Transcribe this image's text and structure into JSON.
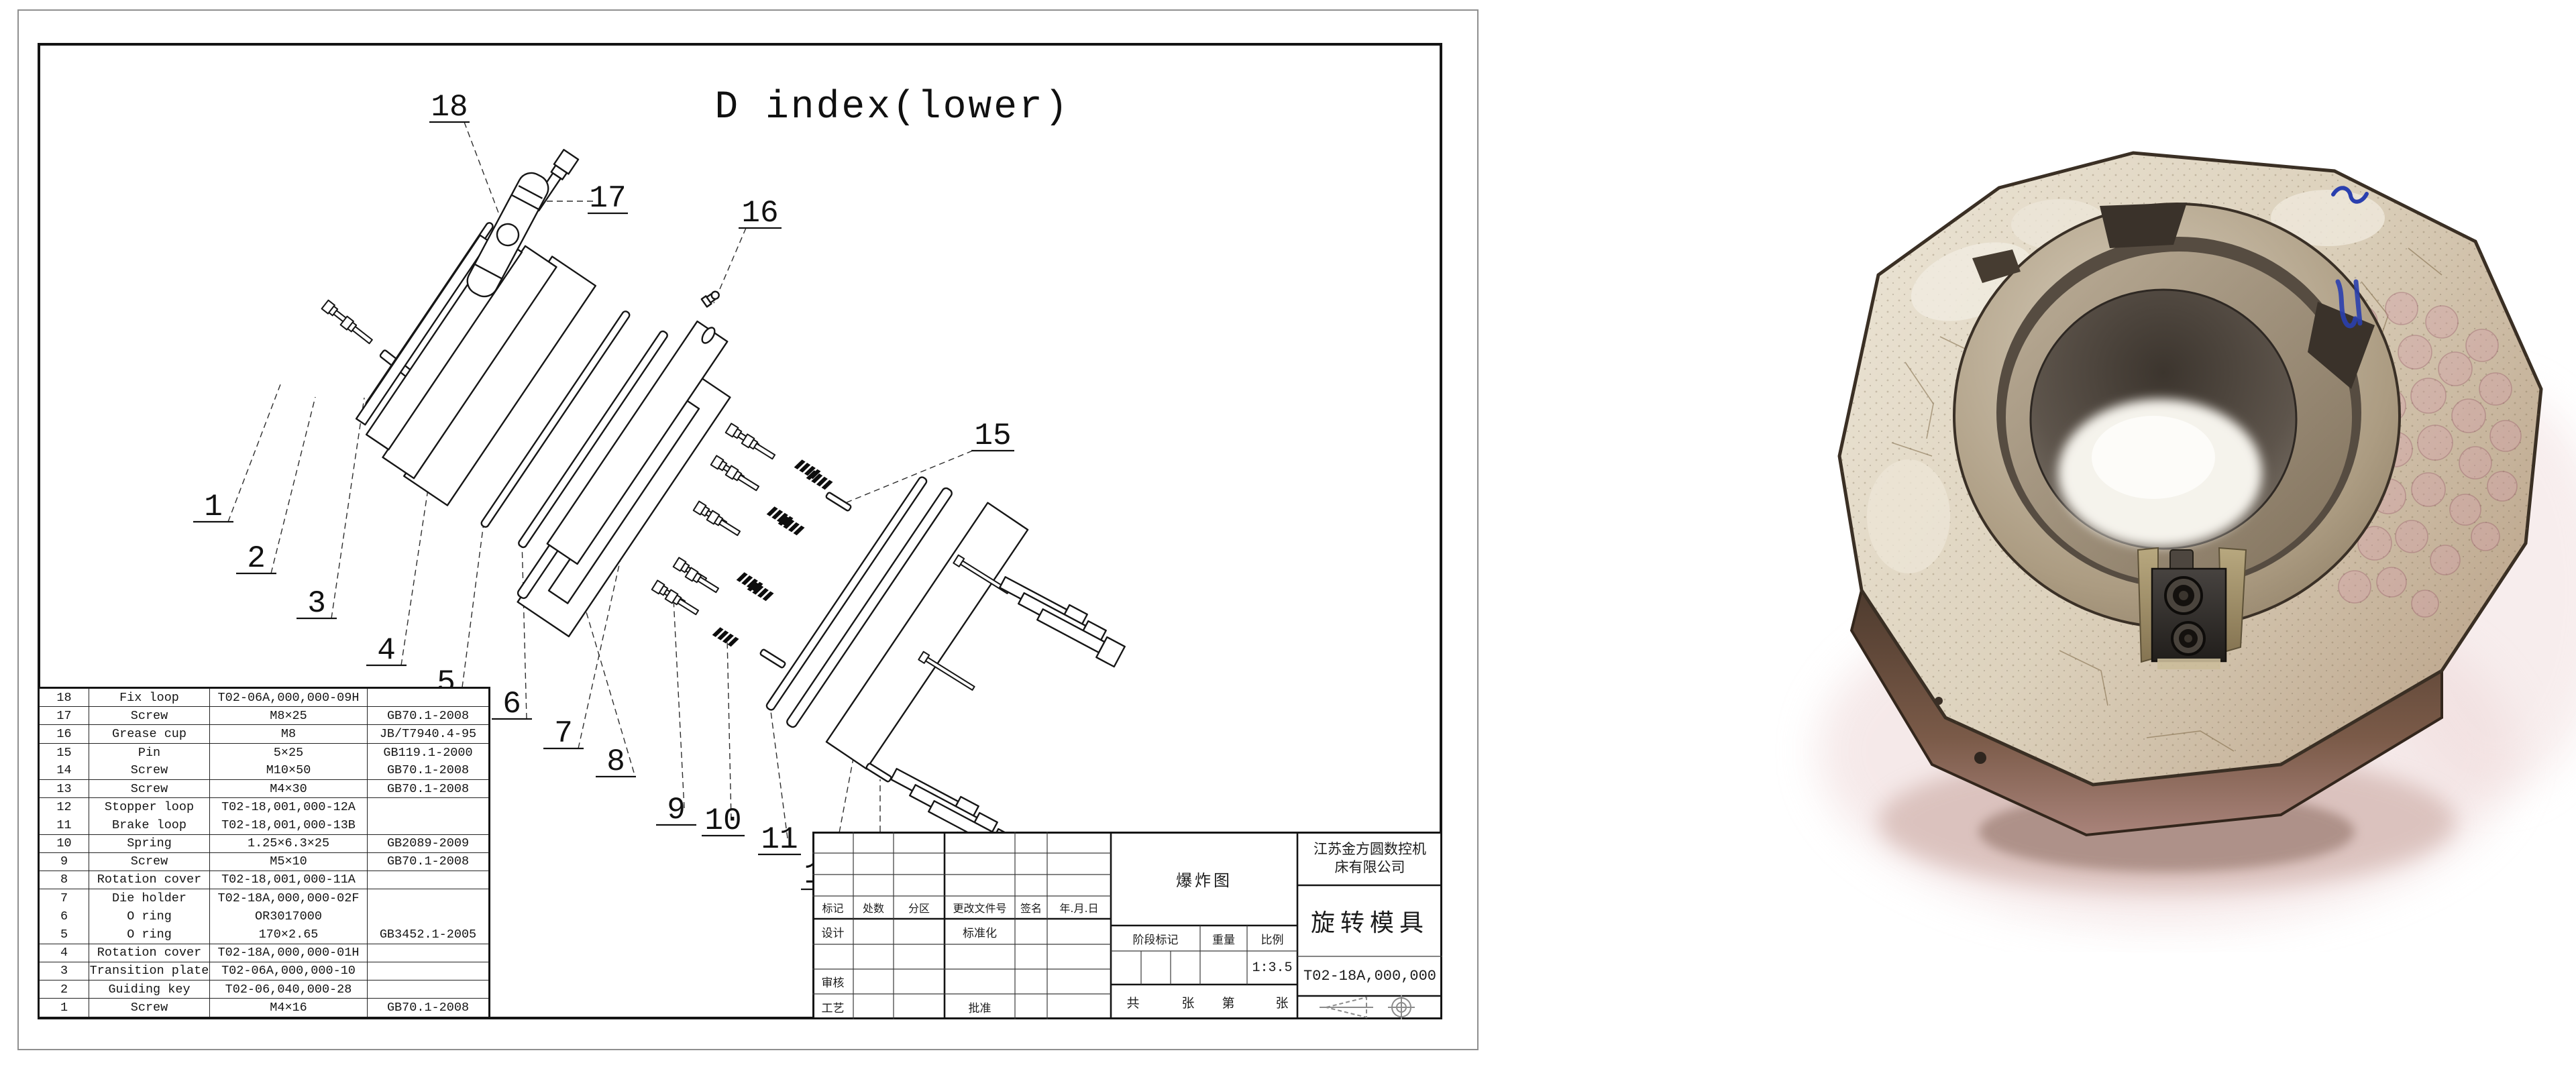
{
  "palette": {
    "ink": "#1b1b1b",
    "paper": "#ffffff",
    "photo_bronze": "#6b5340",
    "photo_tan": "#e7e0d2",
    "photo_pink": "#ecd5d6",
    "marker_blue": "#2a3fae"
  },
  "drawing": {
    "title": "D index(lower)",
    "callouts": [
      "1",
      "2",
      "3",
      "4",
      "5",
      "6",
      "7",
      "8",
      "9",
      "10",
      "11",
      "12",
      "13",
      "14",
      "15",
      "16",
      "17",
      "18"
    ],
    "parts_table": {
      "rows": [
        {
          "no": "18",
          "name": "Fix loop",
          "spec": "T02-06A,000,000-09H",
          "std": ""
        },
        {
          "no": "17",
          "name": "Screw",
          "spec": "M8×25",
          "std": "GB70.1-2008"
        },
        {
          "no": "16",
          "name": "Grease cup",
          "spec": "M8",
          "std": "JB/T7940.4-95"
        },
        {
          "no": "15",
          "name": "Pin",
          "spec": "5×25",
          "std": "GB119.1-2000",
          "m": true
        },
        {
          "no": "14",
          "name": "Screw",
          "spec": "M10×50",
          "std": "GB70.1-2008"
        },
        {
          "no": "13",
          "name": "Screw",
          "spec": "M4×30",
          "std": "GB70.1-2008"
        },
        {
          "no": "12",
          "name": "Stopper loop",
          "spec": "T02-18,001,000-12A",
          "std": "",
          "m": true
        },
        {
          "no": "11",
          "name": "Brake loop",
          "spec": "T02-18,001,000-13B",
          "std": ""
        },
        {
          "no": "10",
          "name": "Spring",
          "spec": "1.25×6.3×25",
          "std": "GB2089-2009"
        },
        {
          "no": "9",
          "name": "Screw",
          "spec": "M5×10",
          "std": "GB70.1-2008"
        },
        {
          "no": "8",
          "name": "Rotation cover",
          "spec": "T02-18,001,000-11A",
          "std": ""
        },
        {
          "no": "7",
          "name": "Die holder",
          "spec": "T02-18A,000,000-02F",
          "std": "",
          "m": true
        },
        {
          "no": "6",
          "name": "O ring",
          "spec": "OR3017000",
          "std": "",
          "m": true
        },
        {
          "no": "5",
          "name": "O ring",
          "spec": "170×2.65",
          "std": "GB3452.1-2005"
        },
        {
          "no": "4",
          "name": "Rotation cover",
          "spec": "T02-18A,000,000-01H",
          "std": ""
        },
        {
          "no": "3",
          "name": "Transition plate",
          "spec": "T02-06A,000,000-10",
          "std": ""
        },
        {
          "no": "2",
          "name": "Guiding key",
          "spec": "T02-06,040,000-28",
          "std": ""
        },
        {
          "no": "1",
          "name": "Screw",
          "spec": "M4×16",
          "std": "GB70.1-2008"
        }
      ]
    },
    "title_block": {
      "company": "江苏金方圆数控机床有限公司",
      "view_name": "爆炸图",
      "product_name": "旋转模具",
      "drawing_no": "T02-18A,000,000",
      "scale": "1:3.5",
      "rev_headers": [
        "标记",
        "处数",
        "分区",
        "更改文件号",
        "签名",
        "年.月.日"
      ],
      "sig_design": "设计",
      "sig_standardization": "标准化",
      "sig_check": "审核",
      "sig_process": "工艺",
      "sig_approve": "批准",
      "stage_mark": "阶段标记",
      "weight": "重量",
      "ratio": "比例",
      "sheet_words": [
        "共",
        "张",
        "第",
        "张"
      ]
    }
  }
}
